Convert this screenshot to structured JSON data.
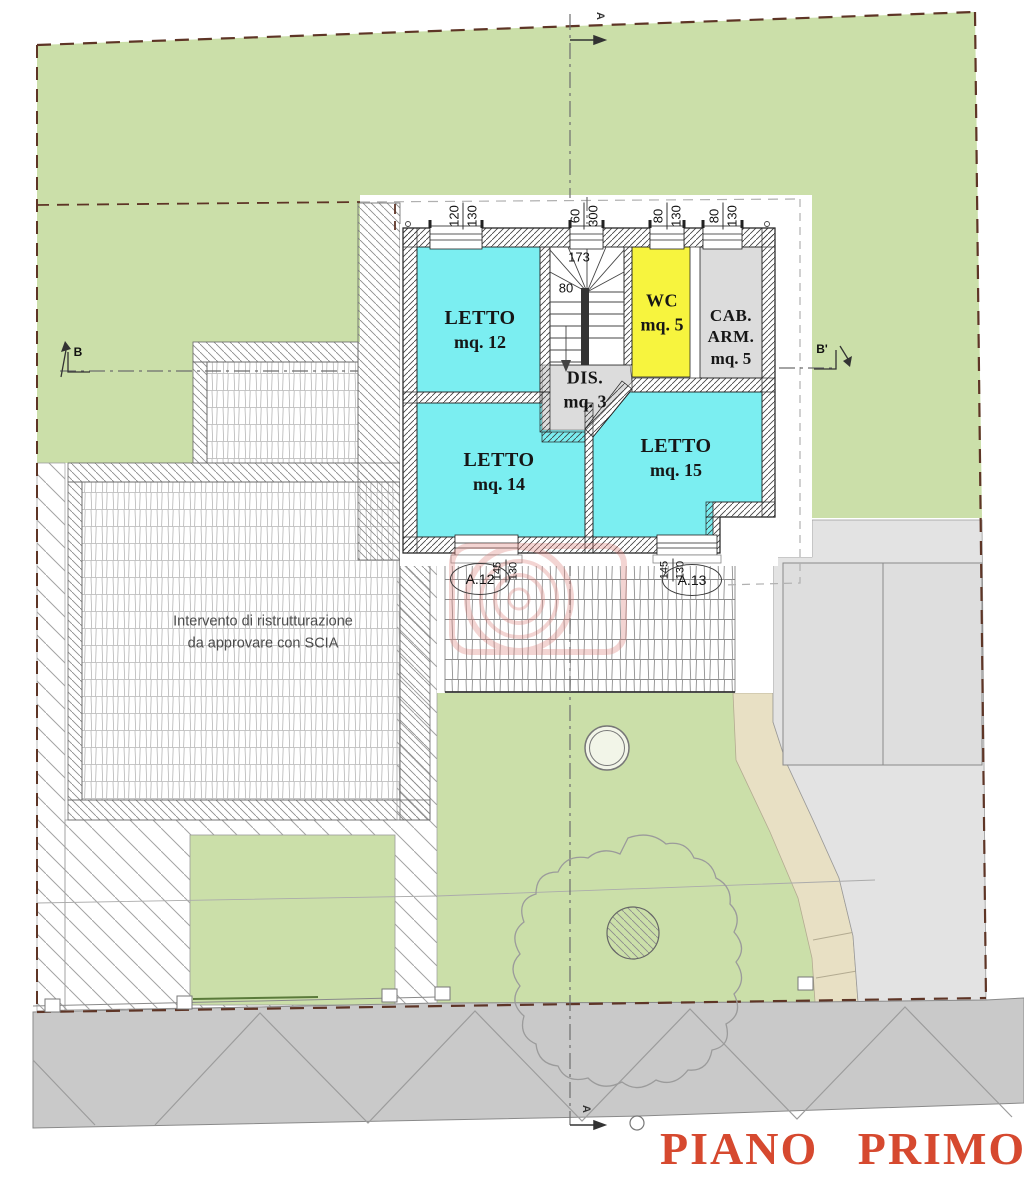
{
  "plan": {
    "title": "PIANO PRIMO",
    "note": {
      "line1": "Intervento di ristrutturazione",
      "line2": "da approvare con SCIA"
    },
    "rooms": {
      "letto12": {
        "name": "LETTO",
        "area": "mq. 12"
      },
      "letto14": {
        "name": "LETTO",
        "area": "mq. 14"
      },
      "letto15": {
        "name": "LETTO",
        "area": "mq. 15"
      },
      "wc": {
        "name": "WC",
        "area": "mq. 5"
      },
      "cab": {
        "name": "CAB.",
        "name2": "ARM.",
        "area": "mq. 5"
      },
      "dis": {
        "name": "DIS.",
        "area": "mq. 3"
      }
    },
    "dims": {
      "win1": {
        "a": "120",
        "b": "130"
      },
      "win2": {
        "a": "60",
        "b": "300"
      },
      "win3": {
        "a": "80",
        "b": "130"
      },
      "win4": {
        "a": "80",
        "b": "130"
      },
      "stairWidth": "173",
      "stairRun": "80",
      "door12": {
        "a": "145",
        "b": "130"
      },
      "door13": {
        "a": "145",
        "b": "130"
      }
    },
    "openings": {
      "a12": "A.12",
      "a13": "A.13"
    },
    "sections": {
      "a": "A",
      "b": "B",
      "bPrime": "B'"
    }
  },
  "colors": {
    "room-cyan": "#7beef1",
    "room-yellow": "#f7f43e",
    "room-gray": "#dcdcdc",
    "site-green": "#cbdfa9",
    "path-beige": "#e8e0c4",
    "road-gray": "#c9c9c9",
    "neighbor-gray": "#e3e3e3",
    "boundary-maroon": "#5e3526",
    "title-red": "#d6492f",
    "stamp-red": "#dd7b76"
  }
}
